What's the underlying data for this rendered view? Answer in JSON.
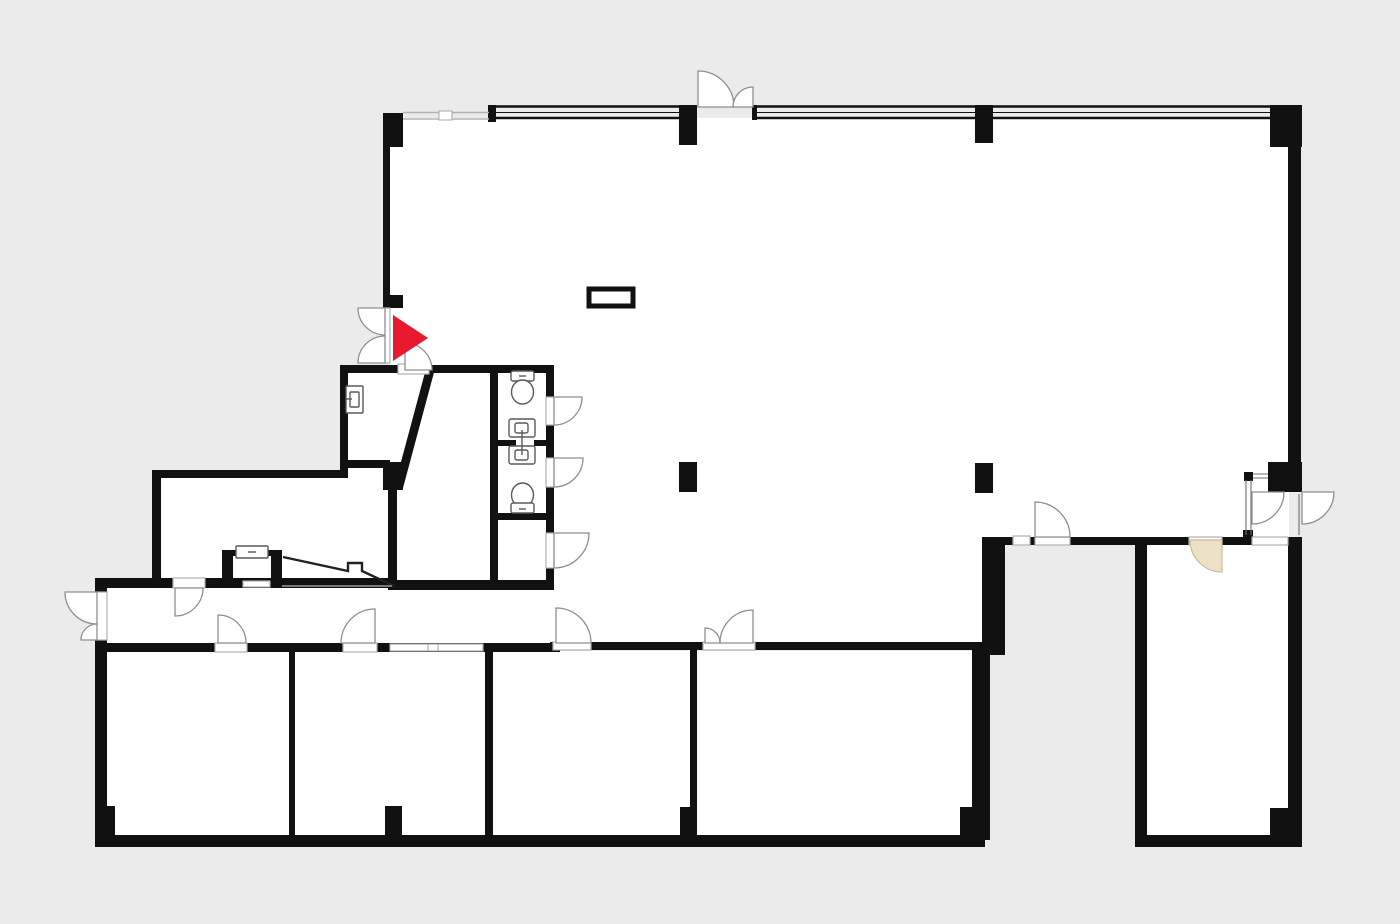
{
  "document": {
    "type": "architectural floor plan",
    "description": "Monochrome office floor plan: thick black walls on light gray background, white rooms, door swing arcs, window bands along the top facade, two WC stalls with toilets and sinks, a stairs direction arrow, a beige door swing in the lower right room, and a red triangular start/entrance flag marker near the upper-left entry doors",
    "visible_text": ""
  },
  "colors": {
    "background": "#ebebeb",
    "floor": "#ffffff",
    "wall": "#111111",
    "door_stroke": "#8f8f8f",
    "threshold_stroke": "#b0b0b0",
    "fixture_stroke": "#5a5a5a",
    "window_gray": "#b3b3b3",
    "glass_stroke": "#6e6e6e",
    "marker_red": "#e8192f",
    "swing_beige": "#ece1c7",
    "swing_beige_stroke": "#c9bc9c",
    "stairs_stroke": "#222222",
    "stairs_baseline": "#9a9a9a"
  },
  "marker": {
    "name": "start-flag",
    "shape": "right-pointing solid triangle flag",
    "location": "at double entry doors on upper-left interior wall"
  },
  "inventory": {
    "toilet_count": 2,
    "sink_count": 3,
    "stair_arrows": 1,
    "interior_columns": 2,
    "double_entry_doors": 2,
    "beige_door_swings": 1
  }
}
